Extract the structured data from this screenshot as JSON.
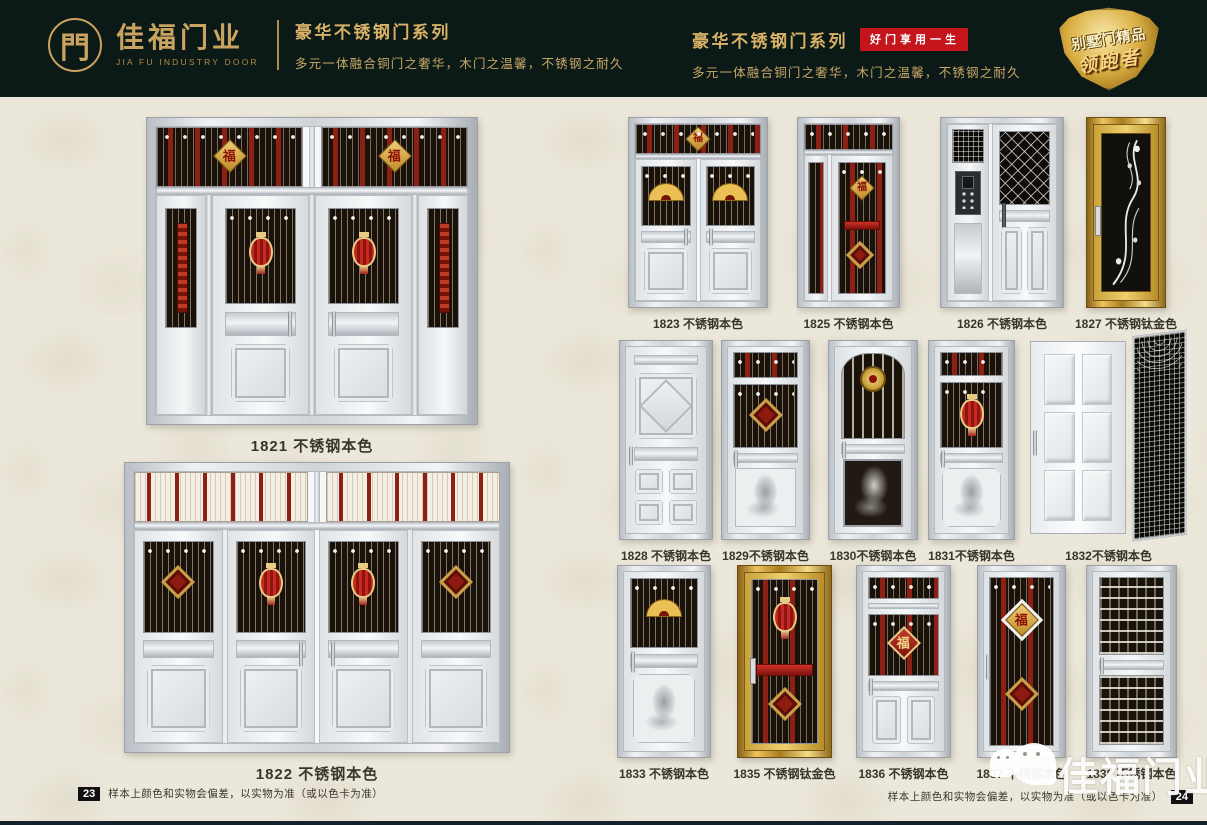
{
  "header": {
    "left": {
      "logo_char": "門",
      "brand_cn": "佳福门业",
      "brand_en": "JIA FU INDUSTRY DOOR",
      "series_title": "豪华不锈钢门系列",
      "series_subtitle": "多元一体融合铜门之奢华，木门之温馨，不锈钢之耐久"
    },
    "right": {
      "series_title": "豪华不锈钢门系列",
      "slogan_badge": "好门享用一生",
      "series_subtitle": "多元一体融合铜门之奢华，木门之温馨，不锈钢之耐久",
      "shield_line1": "别墅门精品",
      "shield_line2": "领跑者"
    }
  },
  "ornaments": {
    "fu": "福"
  },
  "left_page": {
    "doors": [
      {
        "model": "1821",
        "finish": "不锈钢本色",
        "label": "1821 不锈钢本色"
      },
      {
        "model": "1822",
        "finish": "不锈钢本色",
        "label": "1822 不锈钢本色"
      }
    ],
    "footer": {
      "page_number": "23",
      "note": "样本上颜色和实物会偏差，以实物为准（或以色卡为准）"
    }
  },
  "right_page": {
    "rows": [
      [
        {
          "model": "1823",
          "finish": "不锈钢本色",
          "label": "1823 不锈钢本色"
        },
        {
          "model": "1825",
          "finish": "不锈钢本色",
          "label": "1825 不锈钢本色"
        },
        {
          "model": "1826",
          "finish": "不锈钢本色",
          "label": "1826 不锈钢本色"
        },
        {
          "model": "1827",
          "finish": "不锈钢钛金色",
          "label": "1827 不锈钢钛金色"
        }
      ],
      [
        {
          "model": "1828",
          "finish": "不锈钢本色",
          "label": "1828 不锈钢本色"
        },
        {
          "model": "1829",
          "finish": "不锈钢本色",
          "label": "1829不锈钢本色"
        },
        {
          "model": "1830",
          "finish": "不锈钢本色",
          "label": "1830不锈钢本色"
        },
        {
          "model": "1831",
          "finish": "不锈钢本色",
          "label": "1831不锈钢本色"
        },
        {
          "model": "1832",
          "finish": "不锈钢本色",
          "label": "1832不锈钢本色"
        }
      ],
      [
        {
          "model": "1833",
          "finish": "不锈钢本色",
          "label": "1833 不锈钢本色"
        },
        {
          "model": "1835",
          "finish": "不锈钢钛金色",
          "label": "1835 不锈钢钛金色"
        },
        {
          "model": "1836",
          "finish": "不锈钢本色",
          "label": "1836 不锈钢本色"
        },
        {
          "model": "1837",
          "finish": "不锈钢本色",
          "label": "1837 不锈钢本色"
        },
        {
          "model": "1838",
          "finish": "不锈钢本色",
          "label": "1838 不锈钢本色"
        }
      ]
    ],
    "footer": {
      "page_number": "24",
      "note": "样本上颜色和实物会偏差，以实物为准（或以色卡为准）"
    }
  },
  "watermark": {
    "brand": "佳福门业"
  },
  "colors": {
    "header_bg": "#0b1917",
    "gold": "#c9a35f",
    "badge_red": "#c4151c",
    "page_bg": "#ebe7da",
    "label_text": "#3a352c"
  }
}
